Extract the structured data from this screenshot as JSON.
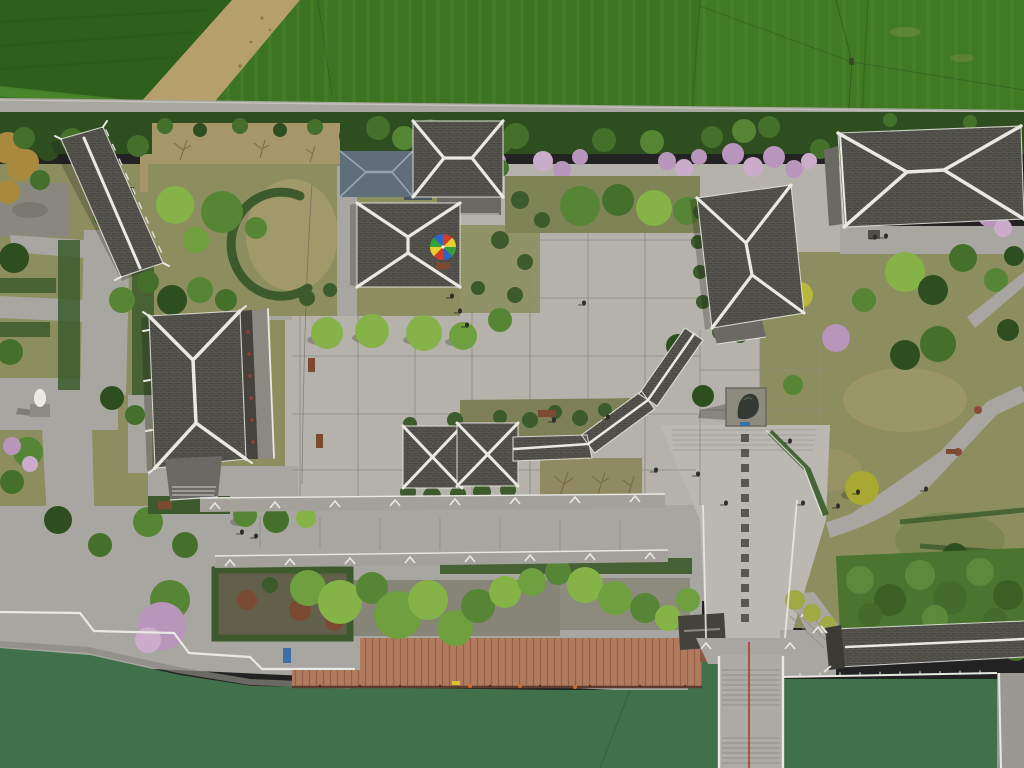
{
  "scene": {
    "domain": "Natural-Image",
    "description": "Aerial drone photograph, looking straight down, of a traditional Chinese temple and garden complex beside a green canal: dark tiled hip roofs with white ridge lines, a paved central plaza with a rainbow parasol, crop fields and a tree line with pink blossoms at the top, a winding garden path on the right, and at the bottom a stone quay with white railings, a red wooden boardwalk, a staircase bridge with a red hand-rail crossing green water, and a covered corridor on the lower right.",
    "no_visible_text": true
  },
  "palette": {
    "fieldDark": "#2e5f1b",
    "fieldMid": "#3d7423",
    "fieldLight": "#4c8a2d",
    "dirt": "#b5a06b",
    "roadGray": "#a5a79e",
    "plaza": "#b4b2aa",
    "axisPave": "#bab8b0",
    "plazaLine": "#8f8d85",
    "pathGray": "#a8a6a0",
    "lawnOlive": "#8c8e5f",
    "lawnTan": "#a79c6d",
    "treeDark": "#2f4e20",
    "treeMid": "#45702c",
    "treeGreen": "#578536",
    "treeLight": "#6f9f3f",
    "treeBright": "#85b347",
    "blossom": "#b895bb",
    "blossomLight": "#cbadcb",
    "autumn": "#a9893d",
    "hedge": "#3c5a2b",
    "roofDark": "#55534d",
    "roofMid": "#6b6963",
    "roofBlue": "#5f6e7a",
    "roofBlueRidge": "#97a6b0",
    "ridge": "#e9e8e2",
    "water": "#40714a",
    "waterDark": "#3a6443",
    "deck": "#b07a5e",
    "deckLine": "#925f49",
    "deckEdge": "#5e3c2d",
    "redRail": "#b23a28",
    "bench": "#7c4a31",
    "bronze": "#343a33",
    "statueWhite": "#eceae4",
    "person": "#2d2d2a",
    "bamboo": "#4a7430",
    "umbrella1": "#d43b2a",
    "umbrella2": "#e8cf2e",
    "umbrella3": "#35a03a",
    "umbrella4": "#2d66c4"
  },
  "objects": {
    "top": [
      "crop-fields",
      "dirt-track",
      "boundary-road",
      "blossom-tree-line"
    ],
    "buildings": [
      "west-long-hall",
      "blue-roof-house",
      "north-pavilion",
      "center-pavilion",
      "main-hall",
      "east-grand-hall",
      "northeast-hall",
      "twin-garden-pavilions",
      "covered-corridor",
      "waterside-kiosk",
      "lakeside-corridor"
    ],
    "plaza": [
      "stone-grid-paving",
      "rainbow-parasol",
      "benches",
      "visitors"
    ],
    "south": [
      "stone-balustrades",
      "willow-garden",
      "planter-bed",
      "quay-railing",
      "wooden-boardwalk",
      "stair-bridge-red-rail",
      "green-canal",
      "stone-pier"
    ],
    "statues": [
      "white-statue-west",
      "bronze-statue-axis"
    ],
    "east": [
      "winding-path",
      "meadow-lawn",
      "bamboo-grove"
    ]
  }
}
